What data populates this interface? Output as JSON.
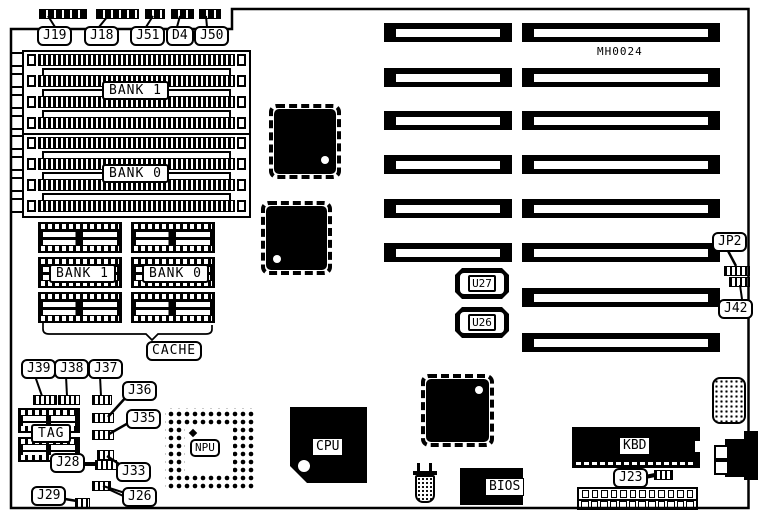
{
  "board": {
    "part_number": "MH0024",
    "line_color": "#000000",
    "background_color": "#ffffff"
  },
  "top_connectors": {
    "j19": {
      "label": "J19"
    },
    "j18": {
      "label": "J18"
    },
    "j51": {
      "label": "J51"
    },
    "d4": {
      "label": "D4"
    },
    "j50": {
      "label": "J50"
    }
  },
  "memory": {
    "simm_bank_top": {
      "label": "BANK 1"
    },
    "simm_bank_bottom": {
      "label": "BANK 0"
    }
  },
  "cache": {
    "bank1": {
      "label": "BANK 1"
    },
    "bank0": {
      "label": "BANK 0"
    },
    "label": "CACHE"
  },
  "jumpers": {
    "j39": {
      "label": "J39"
    },
    "j38": {
      "label": "J38"
    },
    "j37": {
      "label": "J37"
    },
    "j36": {
      "label": "J36"
    },
    "j35": {
      "label": "J35"
    },
    "j33": {
      "label": "J33"
    },
    "j28": {
      "label": "J28"
    },
    "j29": {
      "label": "J29"
    },
    "j26": {
      "label": "J26"
    },
    "jp2": {
      "label": "JP2"
    },
    "j42": {
      "label": "J42"
    },
    "j23": {
      "label": "J23"
    }
  },
  "sockets": {
    "tag": {
      "label": "TAG"
    },
    "npu": {
      "label": "NPU"
    },
    "u27": {
      "label": "U27"
    },
    "u26": {
      "label": "U26"
    }
  },
  "chips": {
    "cpu": {
      "label": "CPU"
    },
    "bios": {
      "label": "BIOS"
    },
    "kbd": {
      "label": "KBD"
    }
  },
  "expansion_slots": {
    "left_column_count": 6,
    "right_column_count": 8
  }
}
